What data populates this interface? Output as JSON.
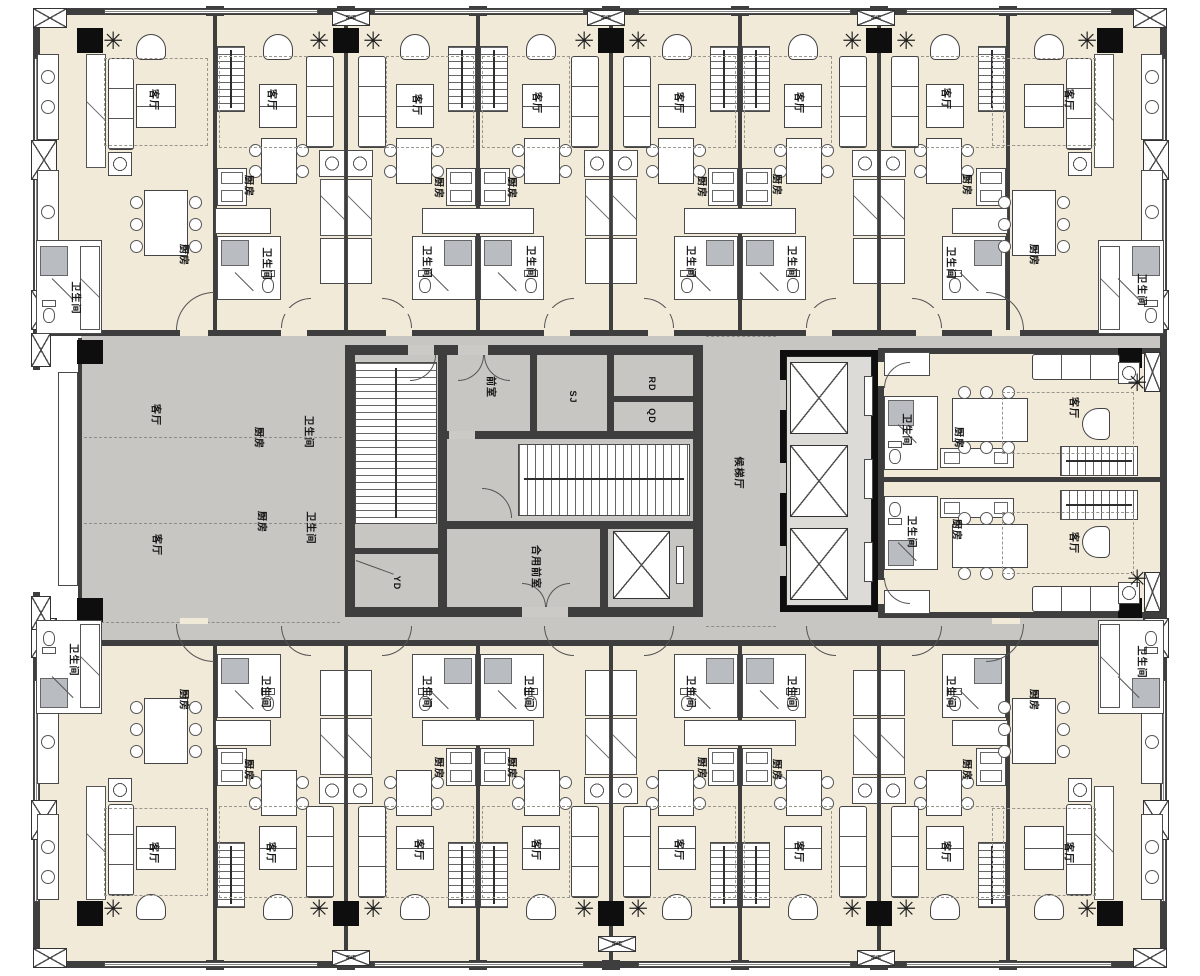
{
  "strings": {
    "living": "客厅",
    "kitchen": "厨房",
    "bath": "卫生间",
    "front_room": "前室",
    "shared_front": "合用前室",
    "elev_lobby": "候梯厅",
    "sj": "SJ",
    "rd": "RD",
    "qd": "QD",
    "yd": "YD",
    "svc": "SVC"
  },
  "colors": {
    "floor_cream": "#f2ead9",
    "corridor_gray": "#c7c6c2",
    "wall_dark": "#3e3e3e",
    "column_black": "#0e0e0e",
    "shower_gray": "#b9bdc2"
  },
  "labels": [
    {
      "k": "living",
      "x": 155,
      "y": 100
    },
    {
      "k": "living",
      "x": 273,
      "y": 100
    },
    {
      "k": "living",
      "x": 418,
      "y": 105
    },
    {
      "k": "living",
      "x": 538,
      "y": 103
    },
    {
      "k": "living",
      "x": 680,
      "y": 103
    },
    {
      "k": "living",
      "x": 800,
      "y": 103
    },
    {
      "k": "living",
      "x": 947,
      "y": 99
    },
    {
      "k": "living",
      "x": 1070,
      "y": 100
    },
    {
      "k": "kitchen",
      "x": 185,
      "y": 255
    },
    {
      "k": "kitchen",
      "x": 250,
      "y": 186
    },
    {
      "k": "kitchen",
      "x": 440,
      "y": 188
    },
    {
      "k": "kitchen",
      "x": 513,
      "y": 188
    },
    {
      "k": "kitchen",
      "x": 703,
      "y": 187
    },
    {
      "k": "kitchen",
      "x": 778,
      "y": 185
    },
    {
      "k": "kitchen",
      "x": 968,
      "y": 185
    },
    {
      "k": "kitchen",
      "x": 1035,
      "y": 255
    },
    {
      "k": "bath",
      "x": 77,
      "y": 298
    },
    {
      "k": "bath",
      "x": 268,
      "y": 264
    },
    {
      "k": "bath",
      "x": 428,
      "y": 262
    },
    {
      "k": "bath",
      "x": 532,
      "y": 262
    },
    {
      "k": "bath",
      "x": 692,
      "y": 262
    },
    {
      "k": "bath",
      "x": 793,
      "y": 262
    },
    {
      "k": "bath",
      "x": 952,
      "y": 263
    },
    {
      "k": "bath",
      "x": 1143,
      "y": 290
    },
    {
      "k": "bath",
      "x": 75,
      "y": 660
    },
    {
      "k": "bath",
      "x": 267,
      "y": 692
    },
    {
      "k": "bath",
      "x": 428,
      "y": 692
    },
    {
      "k": "bath",
      "x": 530,
      "y": 692
    },
    {
      "k": "bath",
      "x": 692,
      "y": 692
    },
    {
      "k": "bath",
      "x": 793,
      "y": 692
    },
    {
      "k": "bath",
      "x": 952,
      "y": 692
    },
    {
      "k": "bath",
      "x": 1143,
      "y": 662
    },
    {
      "k": "kitchen",
      "x": 185,
      "y": 700
    },
    {
      "k": "kitchen",
      "x": 250,
      "y": 770
    },
    {
      "k": "kitchen",
      "x": 440,
      "y": 768
    },
    {
      "k": "kitchen",
      "x": 513,
      "y": 768
    },
    {
      "k": "kitchen",
      "x": 703,
      "y": 768
    },
    {
      "k": "kitchen",
      "x": 778,
      "y": 770
    },
    {
      "k": "kitchen",
      "x": 968,
      "y": 770
    },
    {
      "k": "kitchen",
      "x": 1035,
      "y": 700
    },
    {
      "k": "living",
      "x": 155,
      "y": 853
    },
    {
      "k": "living",
      "x": 272,
      "y": 853
    },
    {
      "k": "living",
      "x": 420,
      "y": 850
    },
    {
      "k": "living",
      "x": 537,
      "y": 850
    },
    {
      "k": "living",
      "x": 680,
      "y": 850
    },
    {
      "k": "living",
      "x": 800,
      "y": 852
    },
    {
      "k": "living",
      "x": 947,
      "y": 852
    },
    {
      "k": "living",
      "x": 1070,
      "y": 853
    },
    {
      "k": "living",
      "x": 157,
      "y": 415
    },
    {
      "k": "kitchen",
      "x": 260,
      "y": 438
    },
    {
      "k": "bath",
      "x": 310,
      "y": 432
    },
    {
      "k": "living",
      "x": 158,
      "y": 545
    },
    {
      "k": "kitchen",
      "x": 263,
      "y": 522
    },
    {
      "k": "bath",
      "x": 312,
      "y": 528
    },
    {
      "k": "bath",
      "x": 908,
      "y": 430
    },
    {
      "k": "kitchen",
      "x": 960,
      "y": 438
    },
    {
      "k": "living",
      "x": 1075,
      "y": 408
    },
    {
      "k": "bath",
      "x": 913,
      "y": 532
    },
    {
      "k": "kitchen",
      "x": 958,
      "y": 530
    },
    {
      "k": "living",
      "x": 1075,
      "y": 543
    },
    {
      "k": "front_room",
      "x": 492,
      "y": 387
    },
    {
      "k": "sj",
      "x": 573,
      "y": 397,
      "fs": 9
    },
    {
      "k": "rd",
      "x": 652,
      "y": 384,
      "fs": 9
    },
    {
      "k": "qd",
      "x": 652,
      "y": 416,
      "fs": 9
    },
    {
      "k": "shared_front",
      "x": 537,
      "y": 567
    },
    {
      "k": "yd",
      "x": 397,
      "y": 583,
      "fs": 9
    },
    {
      "k": "elev_lobby",
      "x": 740,
      "y": 473
    },
    {
      "k": "svc",
      "x": 351,
      "y": 18,
      "fs": 5,
      "rot": 0
    },
    {
      "k": "svc",
      "x": 606,
      "y": 18,
      "fs": 5,
      "rot": 0
    },
    {
      "k": "svc",
      "x": 876,
      "y": 18,
      "fs": 5,
      "rot": 0
    },
    {
      "k": "svc",
      "x": 351,
      "y": 958,
      "fs": 5,
      "rot": 0
    },
    {
      "k": "svc",
      "x": 617,
      "y": 944,
      "fs": 5,
      "rot": 0
    },
    {
      "k": "svc",
      "x": 876,
      "y": 958,
      "fs": 5,
      "rot": 0
    }
  ],
  "layout": {
    "mirror_band_y": 954,
    "mirror_right_y": 966,
    "party_walls": [
      215,
      346,
      478,
      611,
      740,
      879,
      1008
    ],
    "stair_pairs": [
      {
        "b": 215,
        "sides": "right"
      },
      {
        "b": 478,
        "sides": "both"
      },
      {
        "b": 740,
        "sides": "both"
      },
      {
        "b": 1008,
        "sides": "left"
      }
    ],
    "shaft_pairs": [
      346,
      611,
      879
    ],
    "regions": [
      {
        "c": "cream",
        "x": 40,
        "y": 14,
        "w": 1120,
        "h": 318
      },
      {
        "c": "cream",
        "x": 40,
        "y": 644,
        "w": 1120,
        "h": 317
      },
      {
        "c": "gray",
        "x": 81,
        "y": 332,
        "w": 1079,
        "h": 312
      },
      {
        "c": "cream",
        "x": 884,
        "y": 354,
        "w": 276,
        "h": 258
      }
    ],
    "walls": [
      [
        33,
        8,
        1134,
        7
      ],
      [
        33,
        961,
        1134,
        7
      ],
      [
        33,
        8,
        7,
        362
      ],
      [
        33,
        592,
        7,
        376
      ],
      [
        1160,
        8,
        7,
        960
      ],
      [
        40,
        330,
        1120,
        6
      ],
      [
        40,
        640,
        1120,
        6
      ],
      [
        78,
        338,
        4,
        284
      ],
      [
        878,
        348,
        282,
        6
      ],
      [
        878,
        612,
        282,
        6
      ],
      [
        878,
        348,
        6,
        270
      ],
      [
        878,
        477,
        282,
        5
      ]
    ],
    "windows_h": [
      [
        104,
        9,
        214
      ],
      [
        374,
        9,
        210
      ],
      [
        638,
        9,
        213
      ],
      [
        906,
        9,
        206
      ],
      [
        104,
        962,
        214
      ],
      [
        374,
        962,
        210
      ],
      [
        638,
        962,
        213
      ],
      [
        906,
        962,
        206
      ]
    ],
    "windows_v": [
      [
        34,
        58,
        238
      ],
      [
        34,
        680,
        222
      ],
      [
        1161,
        58,
        238
      ],
      [
        1161,
        680,
        222
      ]
    ],
    "xboxes": [
      [
        33,
        8,
        34,
        20
      ],
      [
        1133,
        8,
        34,
        20
      ],
      [
        33,
        948,
        34,
        20
      ],
      [
        1133,
        948,
        34,
        20
      ],
      [
        31,
        140,
        26,
        40
      ],
      [
        31,
        290,
        26,
        40
      ],
      [
        31,
        618,
        26,
        40
      ],
      [
        31,
        800,
        26,
        40
      ],
      [
        1143,
        140,
        26,
        40
      ],
      [
        1143,
        290,
        26,
        40
      ],
      [
        1143,
        618,
        26,
        40
      ],
      [
        1143,
        800,
        26,
        40
      ],
      [
        31,
        333,
        20,
        34
      ],
      [
        31,
        596,
        20,
        34
      ],
      [
        1144,
        352,
        17,
        40
      ],
      [
        1144,
        572,
        17,
        40
      ]
    ],
    "svc_boxes": [
      [
        332,
        10,
        38,
        16
      ],
      [
        587,
        10,
        38,
        16
      ],
      [
        857,
        10,
        38,
        16
      ],
      [
        332,
        950,
        38,
        16
      ],
      [
        598,
        936,
        38,
        16
      ],
      [
        857,
        950,
        38,
        16
      ]
    ],
    "columns": [
      [
        77,
        340,
        26,
        24
      ],
      [
        77,
        598,
        26,
        24
      ],
      [
        1118,
        348,
        24,
        20
      ],
      [
        1118,
        598,
        24,
        20
      ]
    ],
    "dashes": [
      [
        84,
        437,
        258
      ],
      [
        84,
        523,
        258
      ],
      [
        86,
        622,
        254
      ],
      [
        706,
        336,
        70
      ],
      [
        706,
        626,
        70
      ]
    ],
    "core": {
      "walls": [
        [
          345,
          345,
          358,
          10
        ],
        [
          345,
          607,
          358,
          10
        ],
        [
          345,
          345,
          10,
          272
        ],
        [
          693,
          345,
          10,
          272
        ],
        [
          438,
          352,
          9,
          258
        ],
        [
          530,
          352,
          7,
          86
        ],
        [
          607,
          352,
          7,
          86
        ],
        [
          610,
          396,
          87,
          6
        ],
        [
          445,
          431,
          258,
          8
        ],
        [
          445,
          521,
          258,
          8
        ],
        [
          600,
          529,
          8,
          78
        ],
        [
          352,
          548,
          90,
          6
        ]
      ],
      "gaps": [
        [
          458,
          345,
          30,
          10
        ],
        [
          408,
          345,
          26,
          10
        ],
        [
          522,
          607,
          46,
          10
        ],
        [
          449,
          431,
          26,
          8
        ]
      ],
      "stair_left": [
        355,
        362,
        82,
        162
      ],
      "stair_right": [
        518,
        444,
        172,
        72
      ],
      "elevator": [
        613,
        531,
        57,
        68
      ],
      "elevator_cw": [
        676,
        546,
        8,
        38
      ]
    },
    "bank": {
      "outer": [
        780,
        350,
        98,
        262
      ],
      "shaft": [
        786,
        356,
        86,
        250
      ],
      "cars": [
        [
          790,
          362,
          58,
          72
        ],
        [
          790,
          445,
          58,
          72
        ],
        [
          790,
          528,
          58,
          72
        ]
      ],
      "cws": [
        [
          864,
          376,
          9,
          40
        ],
        [
          864,
          459,
          9,
          40
        ],
        [
          864,
          542,
          9,
          40
        ]
      ],
      "notches": [
        [
          780,
          380,
          6,
          30
        ],
        [
          780,
          463,
          6,
          30
        ],
        [
          780,
          546,
          6,
          30
        ]
      ]
    }
  }
}
